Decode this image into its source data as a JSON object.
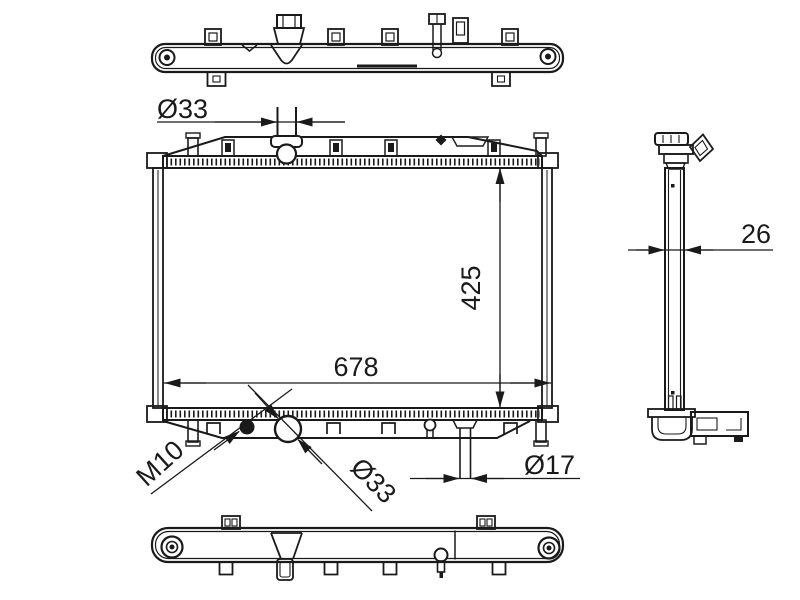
{
  "drawing": {
    "background_color": "#ffffff",
    "line_color": "#1a1a1a",
    "dimensions": {
      "inlet_diameter": "Ø33",
      "core_height": "425",
      "core_width": "678",
      "drain_thread": "M10",
      "outlet_diameter": "Ø33",
      "pipe_diameter": "Ø17",
      "core_thickness": "26"
    }
  }
}
